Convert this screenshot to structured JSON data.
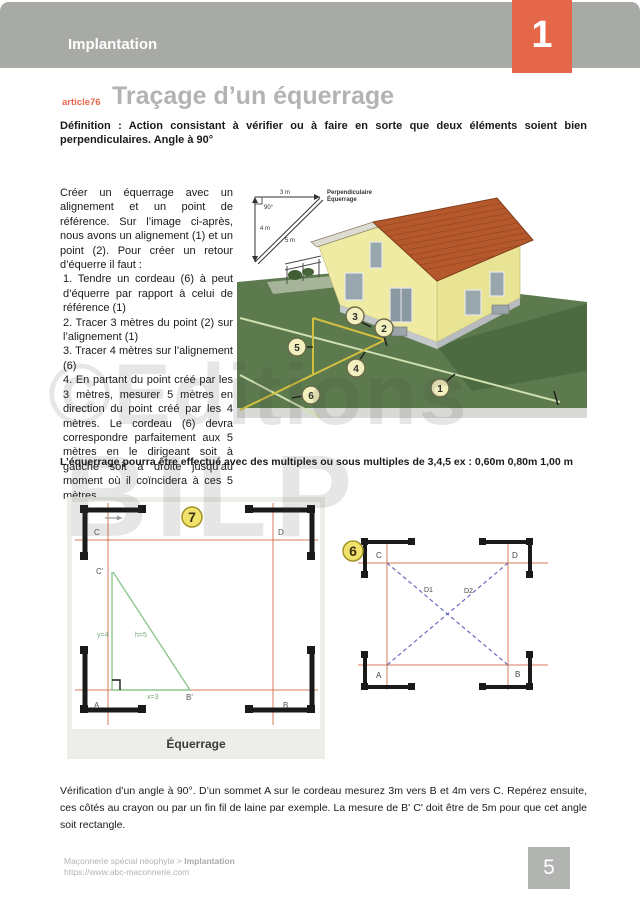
{
  "header": {
    "section": "Implantation",
    "chapter": "1"
  },
  "article": {
    "tag": "article76",
    "title": "Traçage d’un équerrage"
  },
  "definition": "Définition : Action consistant à vérifier ou à faire en sorte que deux éléments soient bien perpendiculaires. Angle à 90°",
  "body": {
    "p1": "Créer un équerrage avec un alignement et un point de référence. Sur l’image ci-après, nous avons un alignement (1) et un point (2). Pour créer un retour d’équerre il faut :",
    "p2": "1. Tendre un cordeau (6) à peut d’équerre par rapport à celui de référence (1)",
    "p3": "2. Tracer 3 mètres du point (2) sur l’alignement (1)",
    "p4": "3. Tracer 4 mètres sur l’alignement (6)",
    "p5": "4. En partant du point créé par les 3 mètres, mesurer 5 mètres en direction du point créé par les 4 mètres. Le cordeau (6) devra correspondre parfaitement aux 5 mètres en le dirigeant soit à gauche soit à droite jusqu’au moment où il coïncidera à ces 5 mètres."
  },
  "note": "L’équerrage pourra être effectué avec des multiples ou sous multiples de 3,4,5 ex : 0,60m 0,80m 1,00 m",
  "illustration": {
    "inset": {
      "top": "3 m",
      "angle": "90°",
      "left": "4 m",
      "hyp": "5 m",
      "caption1": "Perpendiculaire",
      "caption2": "Équerrage"
    },
    "markers": {
      "m1": "1",
      "m2": "2",
      "m3": "3",
      "m4": "4",
      "m5": "5",
      "m6": "6"
    }
  },
  "figure7": {
    "badge": "7",
    "c_top": "C",
    "d_top": "D",
    "c_prime": "C'",
    "a": "A",
    "b": "B",
    "b_prime": "B'",
    "y_label": "y=4",
    "h_label": "h=5",
    "x_label": "x=3",
    "caption": "Équerrage"
  },
  "figure6": {
    "badge": "6",
    "c": "C",
    "d": "D",
    "a": "A",
    "b": "B",
    "d1": "D1",
    "d2": "D2"
  },
  "verification": "Vérification d’un angle à 90°. D’un sommet A sur le cordeau mesurez 3m vers B et 4m vers C. Repérez ensuite, ces côtés au crayon ou par un fin fil de laine par exemple. La mesure de B' C' doit être de 5m pour que cet angle soit rectangle.",
  "watermark": {
    "line1": "©Editions",
    "line2": "BILP"
  },
  "footer": {
    "breadcrumb": "Maçonnerie spécial néophyte > ",
    "breadcrumb_bold": "Implantation",
    "url": "https://www.abc-maconnerie.com",
    "page": "5"
  },
  "colors": {
    "accent_orange": "#e5674a",
    "header_band": "#a7aaa5",
    "title_gray": "#b3b3b3",
    "lawn_green": "#5c7a4e",
    "roof_terracotta": "#b5592c",
    "wall_yellow": "#f0eba2",
    "figure_red_line": "#d9795a",
    "figure_green_line": "#8cc88c",
    "figure_blue_dash": "#6a6ac0",
    "badge_yellow": "#f1e26b"
  }
}
